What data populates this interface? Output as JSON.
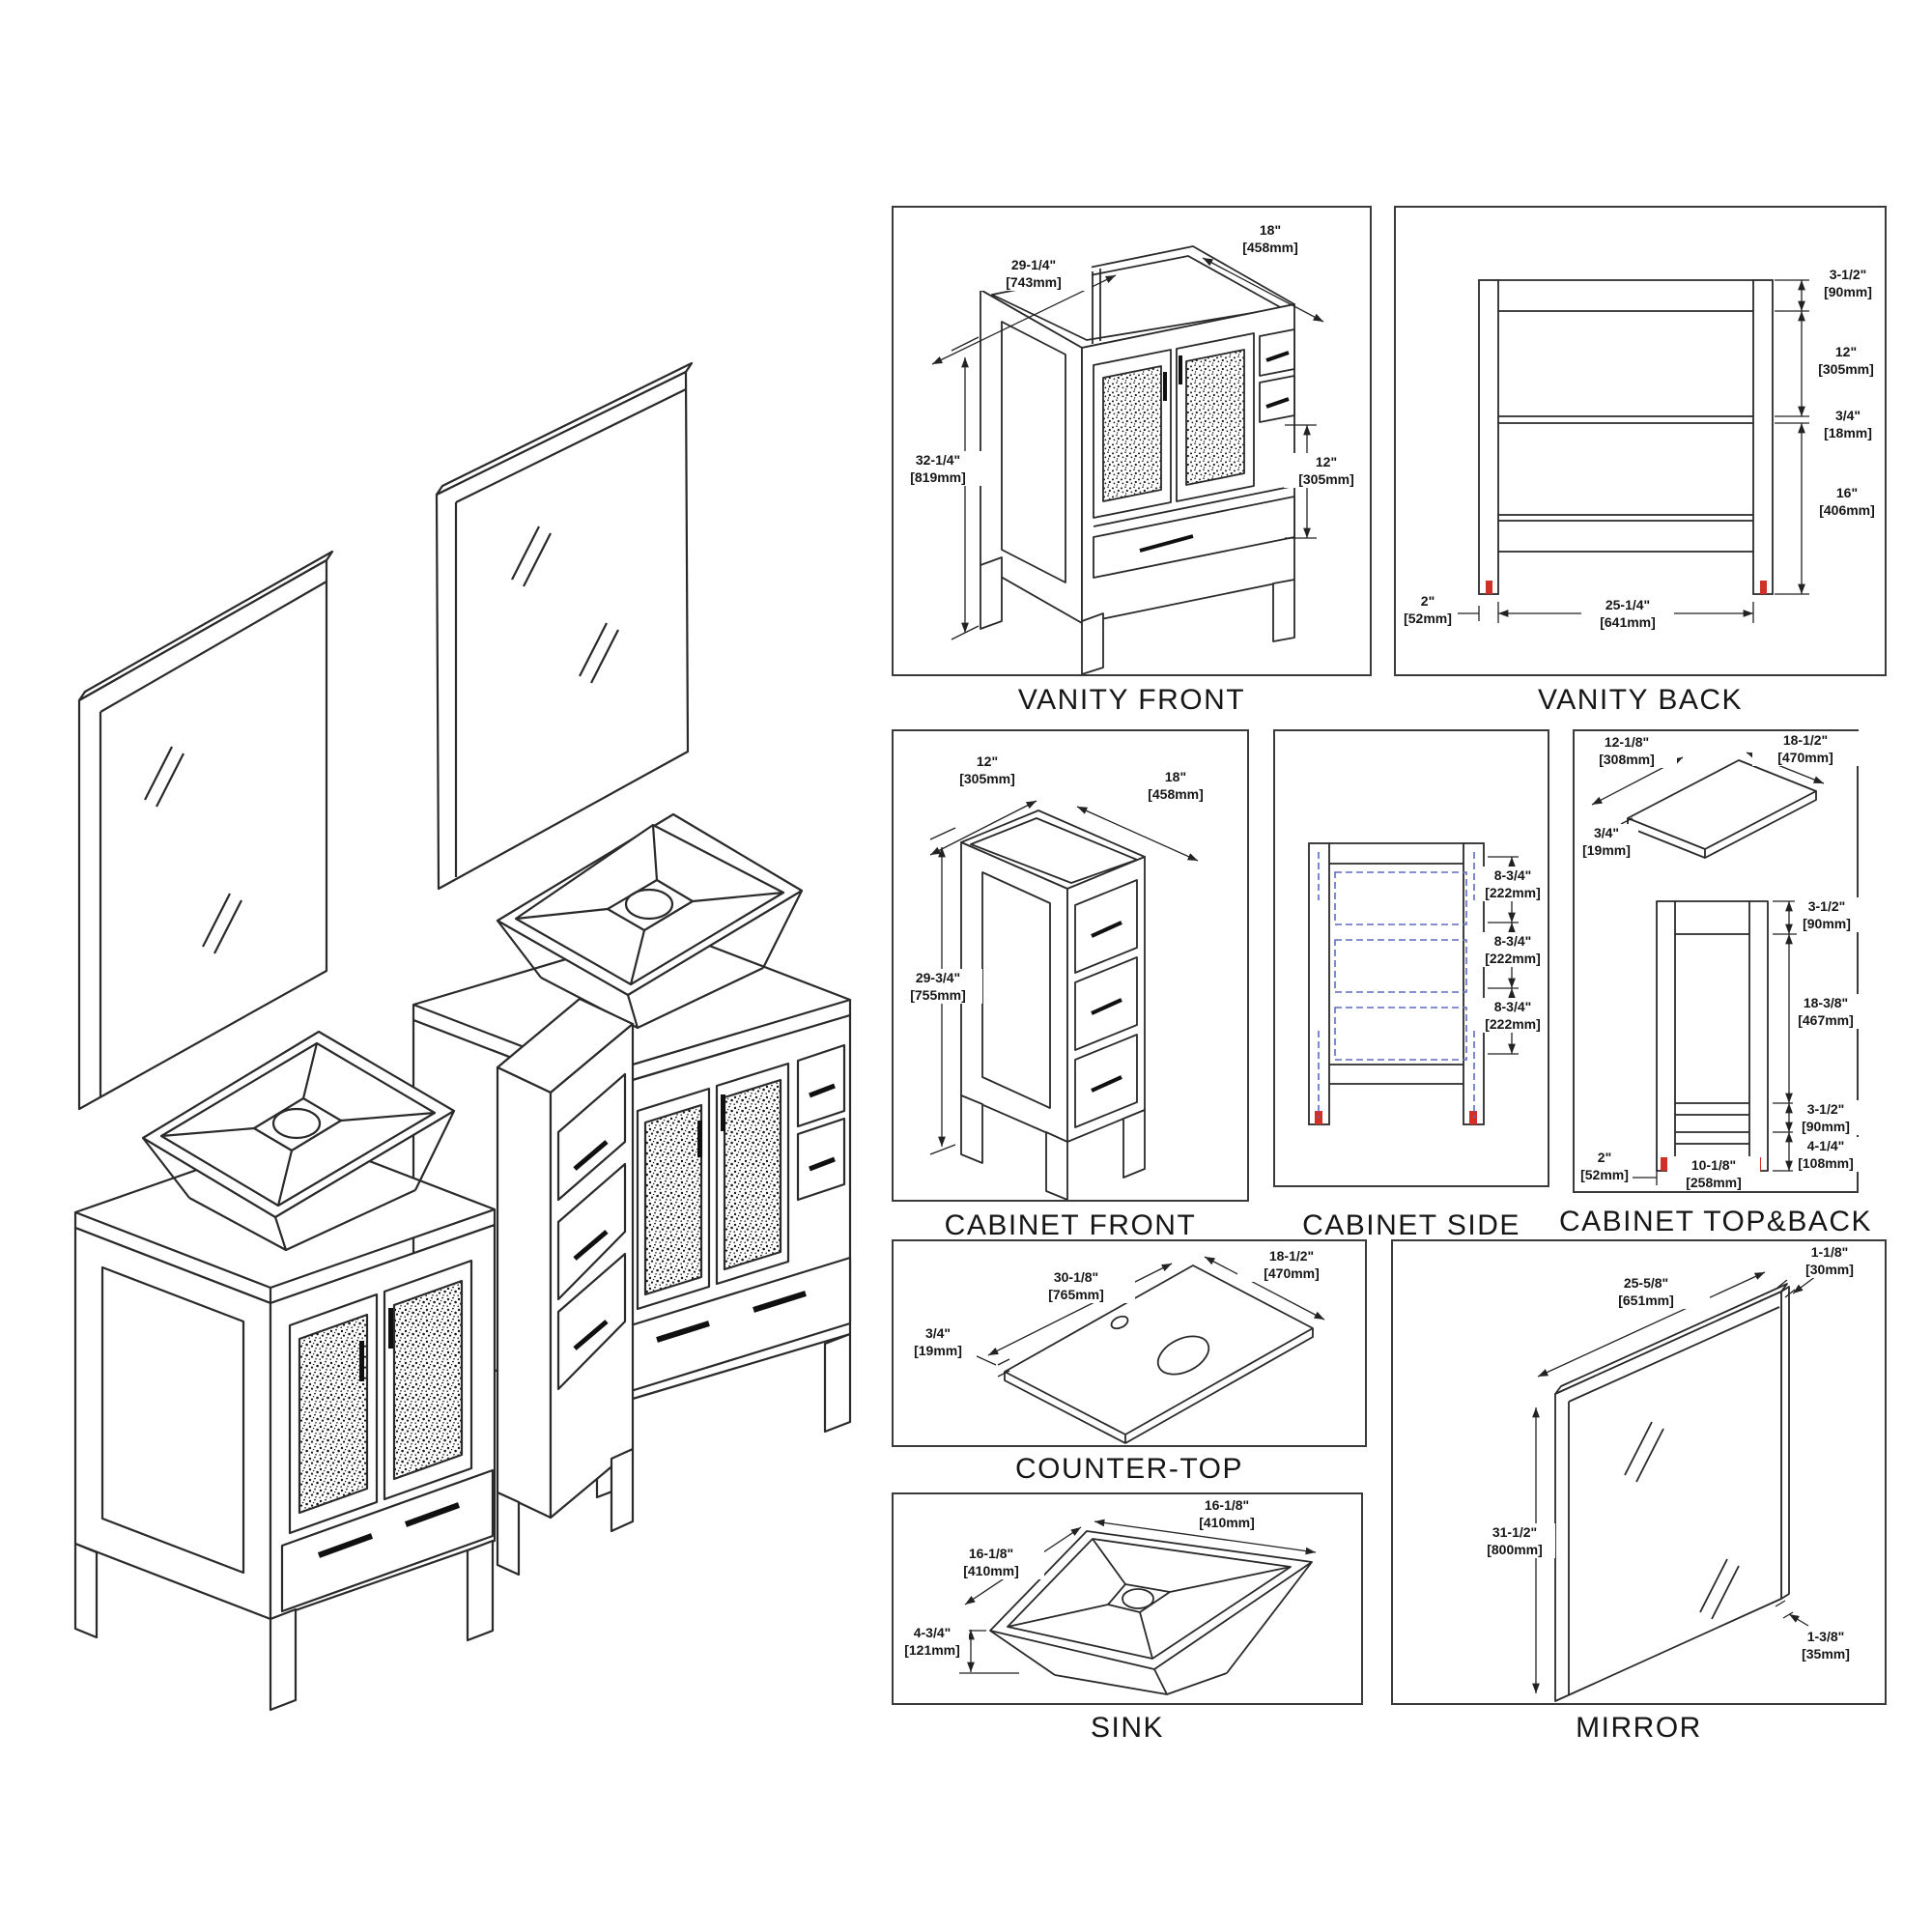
{
  "illustration": {
    "description": "Isometric exploded view of double-sink bathroom vanity set: two framed mirrors, two vessel-sink vanity cabinets with mosaic glass doors and a narrow three-drawer side cabinet"
  },
  "colors": {
    "line": "#2a2a2a",
    "accent_red_feet": "#d03025",
    "dashed_drawer_blue": "#5e6cc0",
    "text": "#161616",
    "background": "#ffffff"
  },
  "panels": {
    "vanity_front": {
      "title": "VANITY FRONT",
      "dims": {
        "w_in": "29-1/4\"",
        "w_mm": "[743mm]",
        "d_in": "18\"",
        "d_mm": "[458mm]",
        "h_in": "32-1/4\"",
        "h_mm": "[819mm]",
        "drawer_in": "12\"",
        "drawer_mm": "[305mm]"
      }
    },
    "vanity_back": {
      "title": "VANITY BACK",
      "dims": {
        "top_in": "3-1/2\"",
        "top_mm": "[90mm]",
        "upper_in": "12\"",
        "upper_mm": "[305mm]",
        "shelf_in": "3/4\"",
        "shelf_mm": "[18mm]",
        "lower_in": "16\"",
        "lower_mm": "[406mm]",
        "leg_in": "2\"",
        "leg_mm": "[52mm]",
        "w_in": "25-1/4\"",
        "w_mm": "[641mm]"
      }
    },
    "cabinet_front": {
      "title": "CABINET FRONT",
      "dims": {
        "w_in": "12\"",
        "w_mm": "[305mm]",
        "d_in": "18\"",
        "d_mm": "[458mm]",
        "h_in": "29-3/4\"",
        "h_mm": "[755mm]"
      }
    },
    "cabinet_side": {
      "title": "CABINET SIDE",
      "dims": {
        "s1_in": "8-3/4\"",
        "s1_mm": "[222mm]",
        "s2_in": "8-3/4\"",
        "s2_mm": "[222mm]",
        "s3_in": "8-3/4\"",
        "s3_mm": "[222mm]"
      }
    },
    "cabinet_topback": {
      "title": "CABINET TOP&BACK",
      "dims": {
        "top_w_in": "12-1/8\"",
        "top_w_mm": "[308mm]",
        "top_d_in": "18-1/2\"",
        "top_d_mm": "[470mm]",
        "top_t_in": "3/4\"",
        "top_t_mm": "[19mm]",
        "bk_top_in": "3-1/2\"",
        "bk_top_mm": "[90mm]",
        "bk_mid_in": "18-3/8\"",
        "bk_mid_mm": "[467mm]",
        "bk_low_in": "3-1/2\"",
        "bk_low_mm": "[90mm]",
        "bk_bot_in": "4-1/4\"",
        "bk_bot_mm": "[108mm]",
        "leg_in": "2\"",
        "leg_mm": "[52mm]",
        "w_in": "10-1/8\"",
        "w_mm": "[258mm]"
      }
    },
    "counter_top": {
      "title": "COUNTER-TOP",
      "dims": {
        "w_in": "30-1/8\"",
        "w_mm": "[765mm]",
        "d_in": "18-1/2\"",
        "d_mm": "[470mm]",
        "t_in": "3/4\"",
        "t_mm": "[19mm]"
      }
    },
    "sink": {
      "title": "SINK",
      "dims": {
        "w_in": "16-1/8\"",
        "w_mm": "[410mm]",
        "d_in": "16-1/8\"",
        "d_mm": "[410mm]",
        "h_in": "4-3/4\"",
        "h_mm": "[121mm]"
      }
    },
    "mirror": {
      "title": "MIRROR",
      "dims": {
        "w_in": "25-5/8\"",
        "w_mm": "[651mm]",
        "t_in": "1-1/8\"",
        "t_mm": "[30mm]",
        "h_in": "31-1/2\"",
        "h_mm": "[800mm]",
        "f_in": "1-3/8\"",
        "f_mm": "[35mm]"
      }
    }
  }
}
